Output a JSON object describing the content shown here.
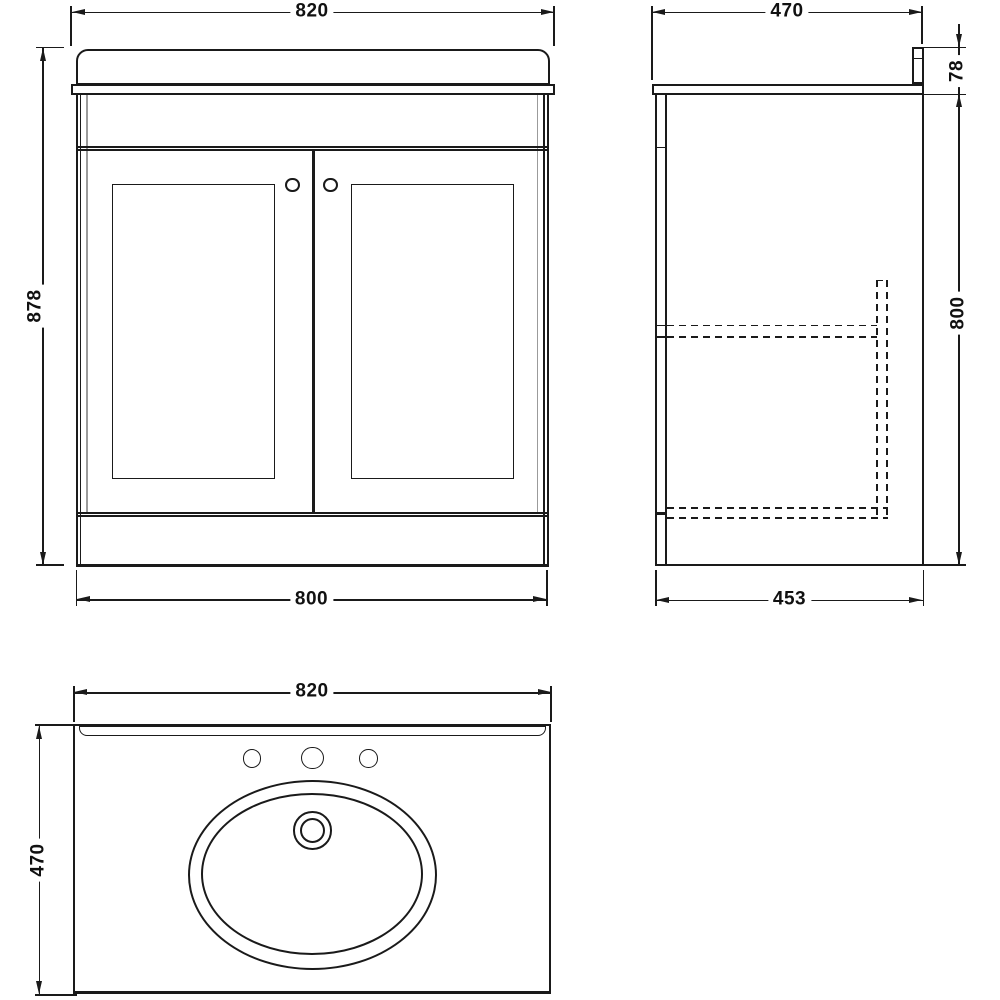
{
  "drawing_type": "vanity-unit-technical-drawing",
  "colors": {
    "line": "#1a1a1a",
    "light_line": "#9b9b9b",
    "background": "#ffffff",
    "dimension_text": "#111111"
  },
  "dims": {
    "front_width_top": "820",
    "front_height": "878",
    "front_width_bottom": "800",
    "side_depth_top": "470",
    "side_upstand_height": "78",
    "side_height": "800",
    "side_depth_bottom": "453",
    "plan_width_top": "820",
    "plan_depth": "470"
  }
}
